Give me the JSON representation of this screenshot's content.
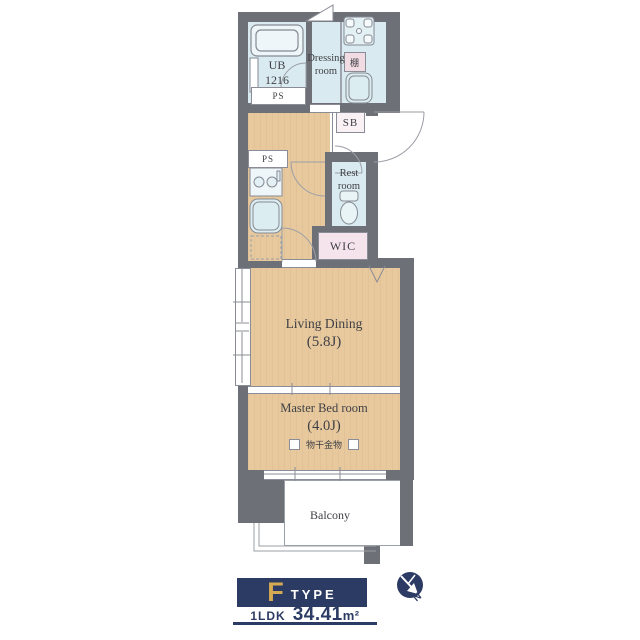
{
  "plan": {
    "ub": {
      "line1": "UB",
      "line2": "1216"
    },
    "ps_top": "PS",
    "ps_mid": "PS",
    "dressing": {
      "line1": "Dressing",
      "line2": "room"
    },
    "shelf": "棚",
    "sb": "SB",
    "rest": {
      "line1": "Rest",
      "line2": "room"
    },
    "wic": "WIC",
    "living": {
      "name": "Living Dining",
      "size": "(5.8J)"
    },
    "bedroom": {
      "name": "Master Bed room",
      "size": "(4.0J)",
      "hardware": "物干金物"
    },
    "balcony": "Balcony"
  },
  "legend": {
    "type_letter": "F",
    "type_word": "TYPE",
    "layout": "1LDK",
    "area": "34.41",
    "area_unit": "m²",
    "compass_n": "N"
  },
  "colors": {
    "wall": "#6e7077",
    "wet_floor": "#d9ebf1",
    "wood_floor": "#e8c99e",
    "accent_navy": "#2c3b63",
    "accent_gold": "#d4ab52",
    "pink": "#f2dce4"
  }
}
